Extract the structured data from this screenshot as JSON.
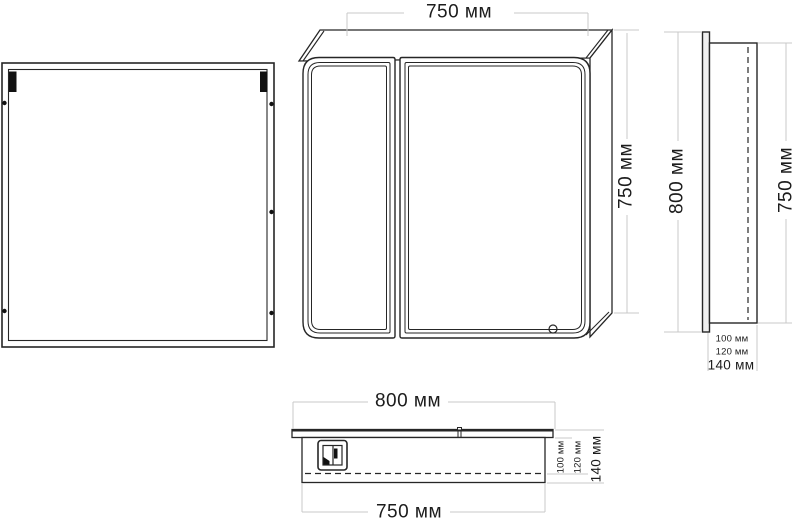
{
  "drawing_title": "Mirror cabinet dimensional drawing",
  "colors": {
    "line": "#262626",
    "light_line": "#c9c9c9",
    "text": "#1c1c1c",
    "fill": "#ffffff",
    "mark": "#111111"
  },
  "views": {
    "front": {
      "width_label": "750 мм",
      "height_label": "750 мм"
    },
    "side": {
      "door_height_label": "800 мм",
      "body_height_label": "750 мм",
      "depth_labels": [
        "100 мм",
        "120 мм",
        "140 мм"
      ]
    },
    "top": {
      "width_label": "800 мм",
      "body_width_label": "750 мм",
      "depth_labels": [
        "100 мм",
        "120 мм",
        "140 мм"
      ]
    }
  }
}
